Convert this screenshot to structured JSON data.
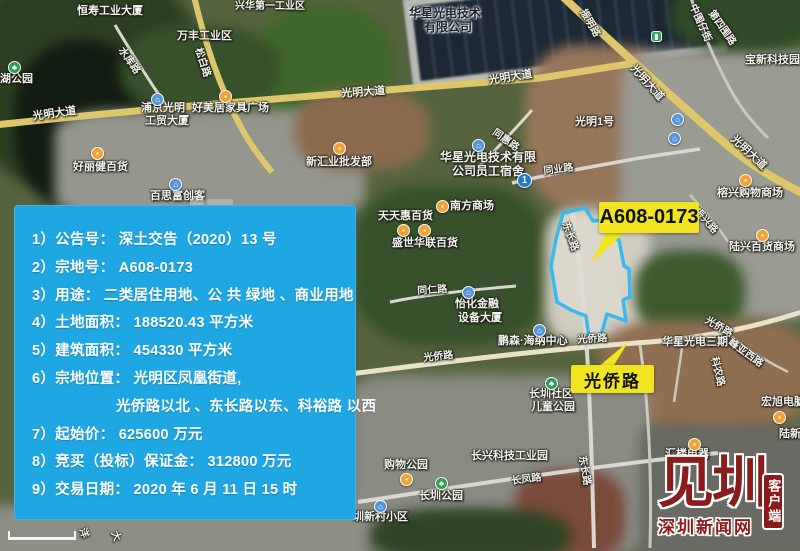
{
  "colors": {
    "panel_bg": "#1ea7e3",
    "callout_bg": "#f0e51e",
    "parcel_outline": "#3ab9f0",
    "logo_red": "#8a1c1c",
    "major_road": "#ddc66b"
  },
  "info_panel": {
    "lines": [
      {
        "t": "1）公告号： 深土交告（2020）13 号",
        "indent": false
      },
      {
        "t": "2）宗地号： A608-0173",
        "indent": false
      },
      {
        "t": "3）用途： 二类居住用地、公 共 绿地 、商业用地",
        "indent": false
      },
      {
        "t": "4）土地面积： 188520.43 平方米",
        "indent": false
      },
      {
        "t": "5）建筑面积： 454330 平方米",
        "indent": false
      },
      {
        "t": "6）宗地位置： 光明区凤凰街道,",
        "indent": false
      },
      {
        "t": "光侨路以北 、东长路以东、科裕路 以西",
        "indent": true
      },
      {
        "t": "7）起始价： 625600 万元",
        "indent": false
      },
      {
        "t": "8）竞买（投标）保证金： 312800 万元",
        "indent": false
      },
      {
        "t": "9）交易日期： 2020 年 6 月 11 日 15 时",
        "indent": false
      }
    ]
  },
  "callouts": {
    "parcel_label": "A608-0173",
    "road_label": "光侨路"
  },
  "logo": {
    "brand": "见圳",
    "client": "客户端",
    "site": "深圳新闻网"
  },
  "map": {
    "labels": [
      {
        "t": "恒寿工业大厦",
        "x": 77,
        "y": 6
      },
      {
        "t": "兴华第一工业区",
        "x": 235,
        "y": 2,
        "fs": 10
      },
      {
        "t": "万丰工业区",
        "x": 177,
        "y": 31
      },
      {
        "t": "水库路",
        "x": 124,
        "y": 46,
        "r": 55,
        "fs": 10,
        "k": "road"
      },
      {
        "t": "松白路",
        "x": 202,
        "y": 47,
        "r": 72,
        "fs": 10,
        "k": "road"
      },
      {
        "t": "湖公园",
        "x": 0,
        "y": 74
      },
      {
        "t": "光明大道",
        "x": 32,
        "y": 112,
        "r": -8,
        "k": "road"
      },
      {
        "t": "浦京光明",
        "x": 141,
        "y": 103
      },
      {
        "t": "工贸大厦",
        "x": 145,
        "y": 116
      },
      {
        "t": "好美居家具广场",
        "x": 192,
        "y": 103
      },
      {
        "t": "好丽健百货",
        "x": 73,
        "y": 162
      },
      {
        "t": "百思富创客",
        "x": 150,
        "y": 191
      },
      {
        "t": "新汇业批发部",
        "x": 306,
        "y": 157
      },
      {
        "t": "光明大道",
        "x": 341,
        "y": 89,
        "r": -4,
        "k": "road"
      },
      {
        "t": "光明大道",
        "x": 488,
        "y": 76,
        "r": -9,
        "k": "road"
      },
      {
        "t": "华星光电技术",
        "x": 409,
        "y": 7,
        "fs": 12,
        "k": "dark"
      },
      {
        "t": "有限公司",
        "x": 424,
        "y": 21,
        "fs": 12,
        "k": "dark"
      },
      {
        "t": "振明路",
        "x": 586,
        "y": 8,
        "r": 60,
        "fs": 10,
        "k": "road"
      },
      {
        "t": "中围仔街",
        "x": 696,
        "y": 3,
        "r": 66,
        "fs": 10,
        "k": "road"
      },
      {
        "t": "第四围路",
        "x": 714,
        "y": 9,
        "r": 55,
        "fs": 10,
        "k": "road"
      },
      {
        "t": "宝新科技园",
        "x": 745,
        "y": 55
      },
      {
        "t": "光明大道",
        "x": 636,
        "y": 63,
        "r": 48,
        "k": "road"
      },
      {
        "t": "光明大道",
        "x": 736,
        "y": 134,
        "r": 43,
        "k": "road"
      },
      {
        "t": "同惠路",
        "x": 496,
        "y": 128,
        "r": 36,
        "fs": 10,
        "k": "road"
      },
      {
        "t": "光明1号",
        "x": 575,
        "y": 117
      },
      {
        "t": "同业路",
        "x": 543,
        "y": 167,
        "r": -7,
        "fs": 10,
        "k": "road"
      },
      {
        "t": "华星光电技术有限",
        "x": 440,
        "y": 151,
        "fs": 12
      },
      {
        "t": "公司员工宿舍",
        "x": 452,
        "y": 165,
        "fs": 12
      },
      {
        "t": "南方商场",
        "x": 450,
        "y": 201
      },
      {
        "t": "天天惠百货",
        "x": 378,
        "y": 211
      },
      {
        "t": "盛世华联百货",
        "x": 392,
        "y": 238
      },
      {
        "t": "东长路",
        "x": 569,
        "y": 221,
        "r": 70,
        "fs": 10,
        "k": "road"
      },
      {
        "t": "振兴路",
        "x": 699,
        "y": 207,
        "r": 48,
        "fs": 10,
        "k": "road"
      },
      {
        "t": "榕兴购物商场",
        "x": 717,
        "y": 188
      },
      {
        "t": "陆兴百货商场",
        "x": 729,
        "y": 242
      },
      {
        "t": "同仁路",
        "x": 417,
        "y": 287,
        "r": -4,
        "fs": 10,
        "k": "road"
      },
      {
        "t": "怡化金融",
        "x": 455,
        "y": 299
      },
      {
        "t": "设备大厦",
        "x": 458,
        "y": 313
      },
      {
        "t": "鹏森·海纳中心",
        "x": 498,
        "y": 336
      },
      {
        "t": "光侨路",
        "x": 577,
        "y": 336,
        "r": -4,
        "fs": 10,
        "k": "road"
      },
      {
        "t": "光侨路",
        "x": 423,
        "y": 354,
        "r": -6,
        "fs": 10,
        "k": "road"
      },
      {
        "t": "光侨路",
        "x": 708,
        "y": 316,
        "r": 30,
        "fs": 10,
        "k": "road"
      },
      {
        "t": "华星光电三期",
        "x": 662,
        "y": 337
      },
      {
        "t": "科农路",
        "x": 718,
        "y": 356,
        "r": 76,
        "fs": 10,
        "k": "road"
      },
      {
        "t": "峰亚西路",
        "x": 732,
        "y": 338,
        "r": 36,
        "fs": 10,
        "k": "road"
      },
      {
        "t": "宏旭电脑",
        "x": 761,
        "y": 397
      },
      {
        "t": "陆新",
        "x": 779,
        "y": 429
      },
      {
        "t": "汇楼电器",
        "x": 665,
        "y": 449
      },
      {
        "t": "长圳社区",
        "x": 529,
        "y": 389
      },
      {
        "t": "儿童公园",
        "x": 531,
        "y": 402
      },
      {
        "t": "长兴科技工业园",
        "x": 471,
        "y": 451
      },
      {
        "t": "长凤路",
        "x": 511,
        "y": 477,
        "r": -7,
        "fs": 10,
        "k": "road"
      },
      {
        "t": "东长路",
        "x": 586,
        "y": 455,
        "r": 80,
        "fs": 10,
        "k": "road"
      },
      {
        "t": "购物公园",
        "x": 384,
        "y": 460
      },
      {
        "t": "长圳公园",
        "x": 419,
        "y": 491
      },
      {
        "t": "圳新村小区",
        "x": 353,
        "y": 512
      },
      {
        "t": "洋",
        "x": 86,
        "y": 527,
        "r": 70,
        "fs": 10,
        "k": "road"
      },
      {
        "t": "大",
        "x": 118,
        "y": 530,
        "r": 70,
        "fs": 10,
        "k": "road"
      }
    ],
    "pois": [
      {
        "k": "park",
        "x": 8,
        "y": 61
      },
      {
        "k": "shop",
        "x": 91,
        "y": 147
      },
      {
        "k": "shop",
        "x": 219,
        "y": 90
      },
      {
        "k": "building",
        "x": 151,
        "y": 93
      },
      {
        "k": "building",
        "x": 169,
        "y": 178
      },
      {
        "k": "shop",
        "x": 333,
        "y": 142
      },
      {
        "k": "shop",
        "x": 397,
        "y": 224
      },
      {
        "k": "shop",
        "x": 418,
        "y": 224
      },
      {
        "k": "shop",
        "x": 436,
        "y": 200
      },
      {
        "k": "building",
        "x": 472,
        "y": 139
      },
      {
        "k": "metro",
        "x": 517,
        "y": 173,
        "n": "1"
      },
      {
        "k": "transit",
        "x": 651,
        "y": 31
      },
      {
        "k": "building",
        "x": 671,
        "y": 113
      },
      {
        "k": "building",
        "x": 668,
        "y": 132
      },
      {
        "k": "shop",
        "x": 739,
        "y": 174
      },
      {
        "k": "shop",
        "x": 756,
        "y": 229
      },
      {
        "k": "building",
        "x": 462,
        "y": 286
      },
      {
        "k": "building",
        "x": 533,
        "y": 324
      },
      {
        "k": "park",
        "x": 545,
        "y": 377
      },
      {
        "k": "shop",
        "x": 400,
        "y": 473
      },
      {
        "k": "park",
        "x": 435,
        "y": 477
      },
      {
        "k": "building",
        "x": 374,
        "y": 500
      },
      {
        "k": "shop",
        "x": 773,
        "y": 411
      },
      {
        "k": "shop",
        "x": 688,
        "y": 438
      }
    ]
  }
}
